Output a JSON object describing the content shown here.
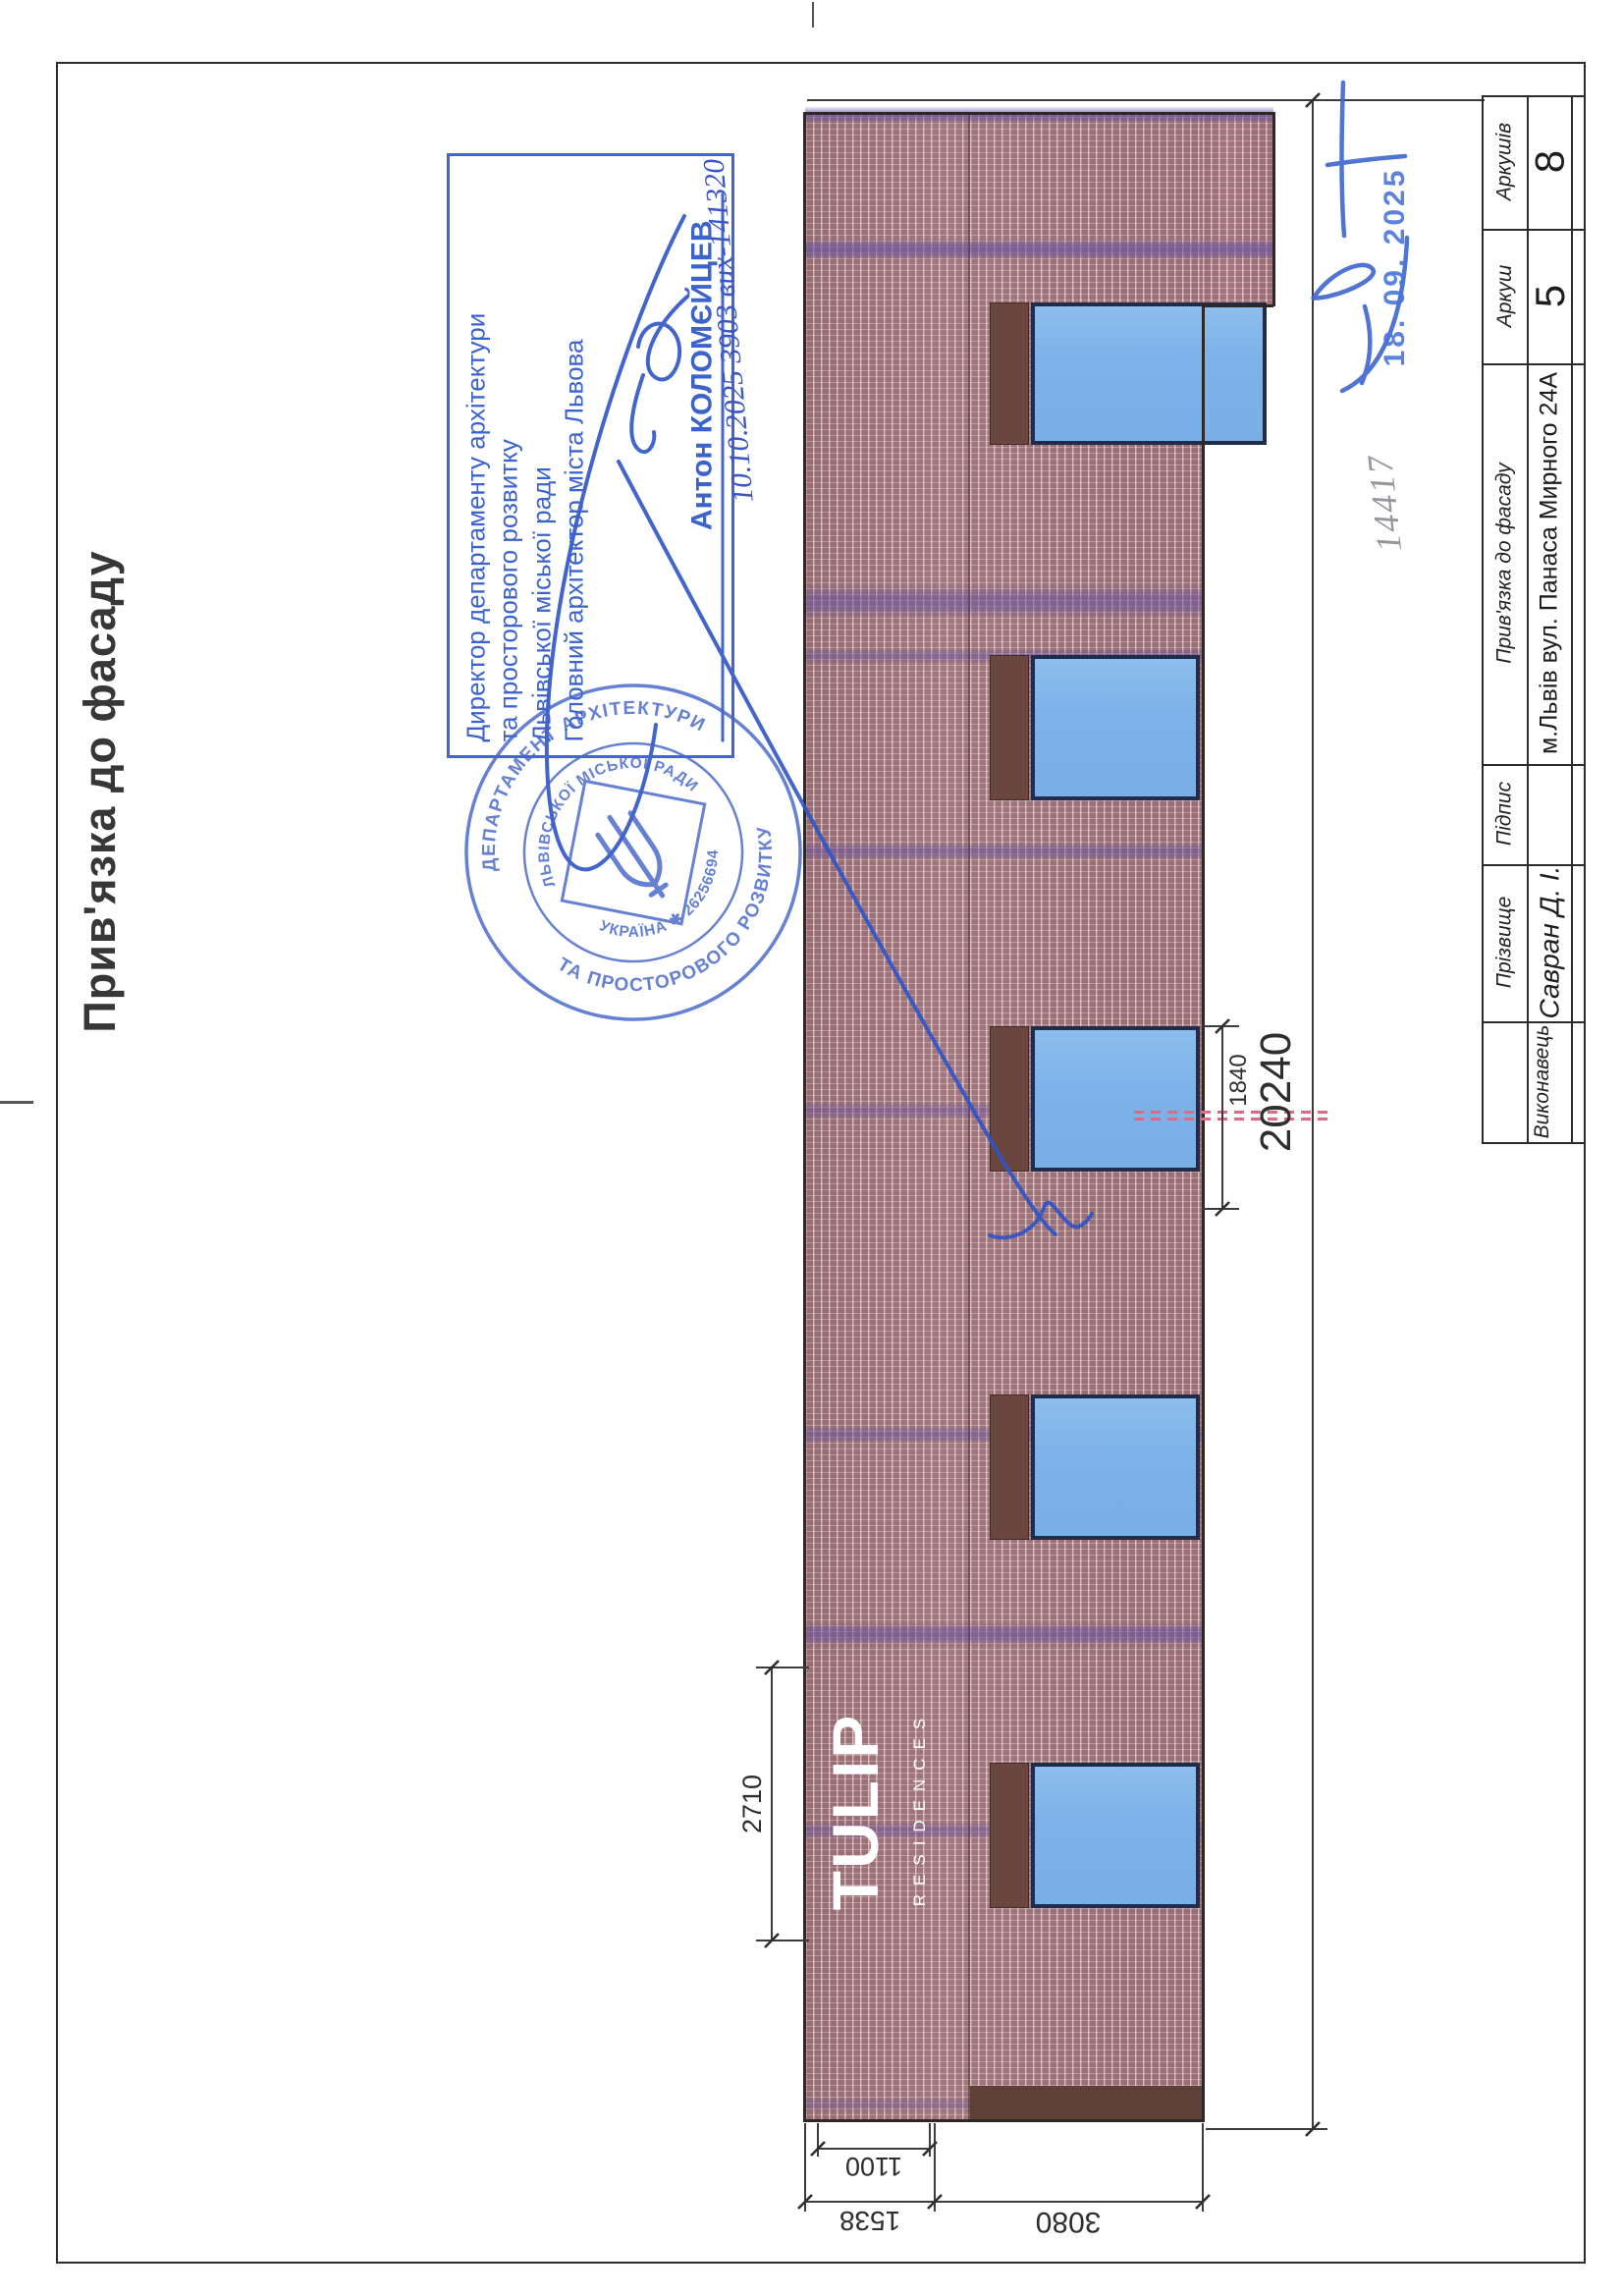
{
  "page_title": "Прив'язка до фасаду",
  "approval_stamp": {
    "line1": "Директор департаменту архітектури",
    "line2": "та просторового розвитку",
    "line3": "Львівської міської ради",
    "line4": "Головний архітектор міста Львова",
    "name": "Антон КОЛОМЄЙЦЕВ",
    "handwritten_number": "10.10.2025 3903 вих-141320"
  },
  "seal": {
    "ring_top": "ДЕПАРТАМЕНТ АРХІТЕКТУРИ",
    "ring_bottom": "ТА ПРОСТОРОВОГО РОЗВИТКУ",
    "inner_top": "ЛЬВІВСЬКОЇ МІСЬКОЇ РАДИ",
    "inner_bottom": "УКРАЇНА ✱ 26256694"
  },
  "date_stamp": "18. 09. 2025",
  "handwritten_note": "14417",
  "logo": {
    "name": "TULIP",
    "subtitle": "RESIDENCES"
  },
  "dimensions": {
    "logo_offset": "2710",
    "window_height": "1840",
    "total_length": "20240",
    "bottom_first": "1100",
    "bottom_second": "1538",
    "bottom_third": "3080"
  },
  "title_block": {
    "sheets_label": "Аркушів",
    "sheets_value": "8",
    "sheet_label": "Аркуш",
    "sheet_value": "5",
    "subject_label": "Прив'язка до фасаду",
    "subject_value": "м.Львів вул. Панаса Мирного 24А",
    "signature_label": "Підпис",
    "surname_label": "Прізвище",
    "surname_value": "Савран Д. І.",
    "executor_label": "Виконавець"
  },
  "colors": {
    "stamp_blue": "#4466cc",
    "seal_blue": "#4565cb",
    "brick": "#a3757c",
    "purple_band": "#6852a0",
    "window_blue": "#7db2e9",
    "red_dash": "#e06a84",
    "pencil_gray": "#84848b"
  }
}
